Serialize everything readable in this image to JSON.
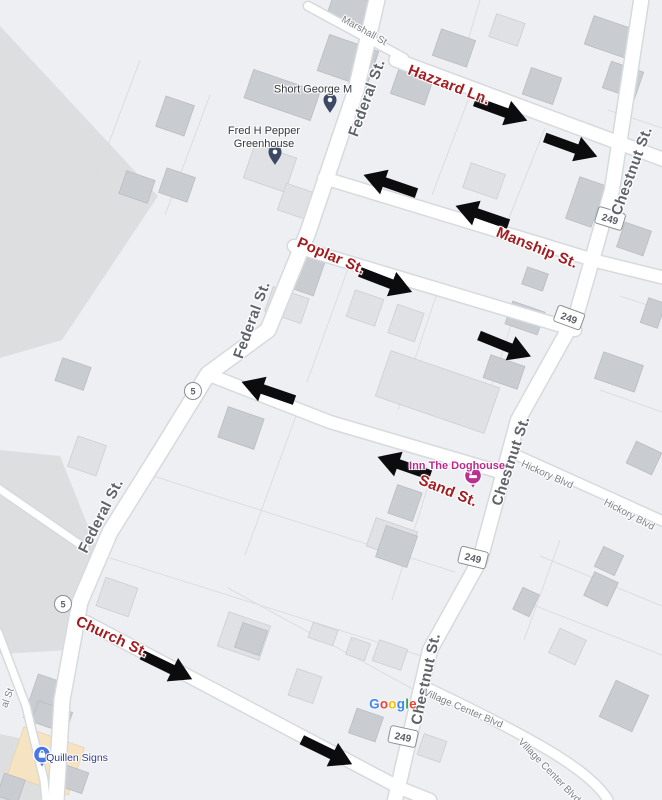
{
  "streets": {
    "marshall": "Marshall St",
    "federal": "Federal St.",
    "federal_partial": "al St",
    "hazzard": "Hazzard Ln.",
    "manship": "Manship St.",
    "poplar": "Poplar St.",
    "sand": "Sand St.",
    "church": "Church St.",
    "chestnut": "Chestnut St.",
    "hickory": "Hickory Blvd",
    "village_center": "Village Center Blvd"
  },
  "shields": {
    "route_249": "249",
    "route_5": "5"
  },
  "pois": {
    "short_george": "Short George M",
    "fred_pepper_line1": "Fred H Pepper",
    "fred_pepper_line2": "Greenhouse",
    "inn_doghouse": "Inn The Doghouse",
    "quillen_signs": "Quillen Signs"
  },
  "watermark": {
    "l1": "G",
    "l2": "o",
    "l3": "o",
    "l4": "g",
    "l5": "l",
    "l6": "e"
  },
  "colors": {
    "map_background": "#edeff2",
    "gray_zone": "#dcdee0",
    "road_fill": "#ffffff",
    "road_casing": "#d7dadd",
    "building_light": "#dfe1e5",
    "building_dark": "#c9ccd1",
    "commercial_area": "#f6e3c1",
    "oneway_street_label": "#a11d20",
    "street_label": "#5f646b",
    "minor_street_label": "#7c8187",
    "oneway_arrow": "#0c0c0e",
    "poi_generic_pin": "#3c4964",
    "poi_lodging": "#bb2a8c",
    "poi_shop": "#2f3f92",
    "google_blue": "#4285F4",
    "google_red": "#EA4335",
    "google_yellow": "#FBBC05",
    "google_green": "#34A853"
  }
}
